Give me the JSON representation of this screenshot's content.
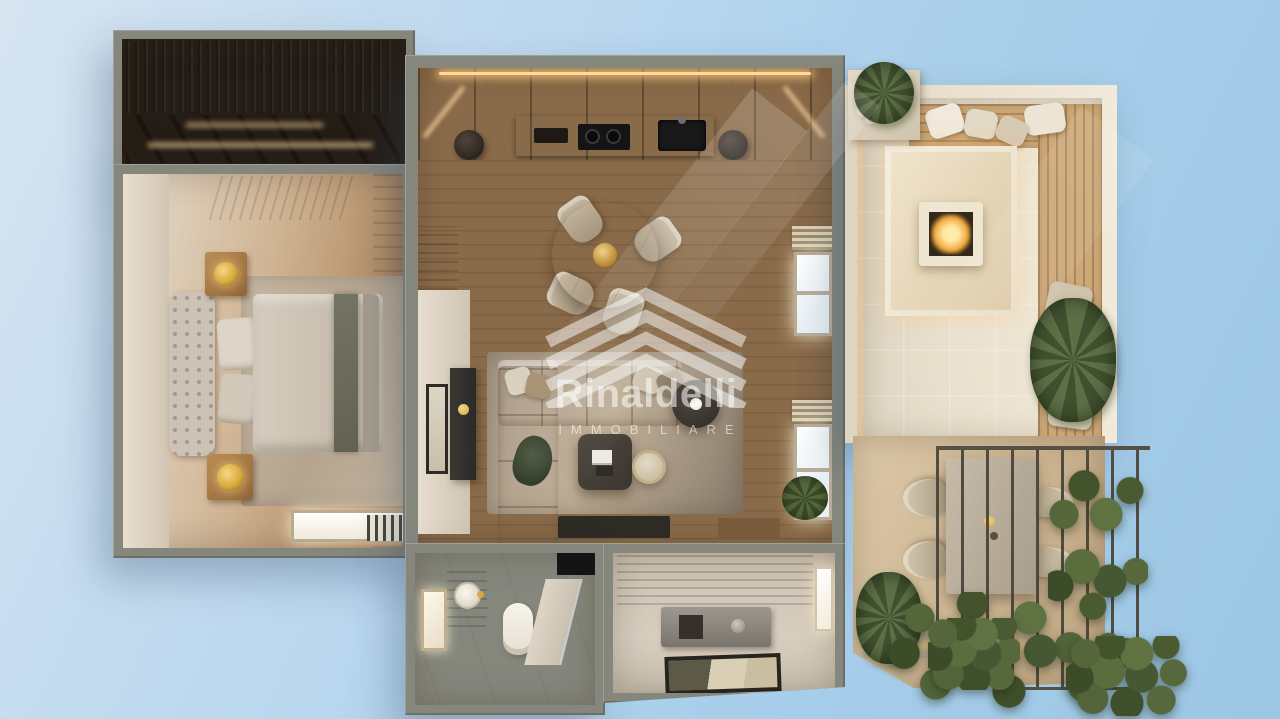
{
  "watermark": {
    "brand": "Rinaldelli",
    "tagline": "IMMOBILIARE",
    "logo_icon": "nested-roof-chevrons"
  },
  "palette": {
    "sky_light": "#d6e4f0",
    "sky_deep": "#9cc6e4",
    "wall_gray": "#85877d",
    "terrace_wall": "#e9e0cd",
    "wood_dark": "#41342a",
    "wood_floor_mid": "#96764f",
    "marble_light": "#efe9dd",
    "stone_beige": "#d8c5a6",
    "carpet_tan": "#c9ad89",
    "foliage_green": "#4c5d38",
    "fire_glow": "#f2a93c",
    "led_warm": "#ffd9a0",
    "gold_accent": "#d8a93e",
    "watermark_text": "rgba(255,255,255,0.55)"
  }
}
